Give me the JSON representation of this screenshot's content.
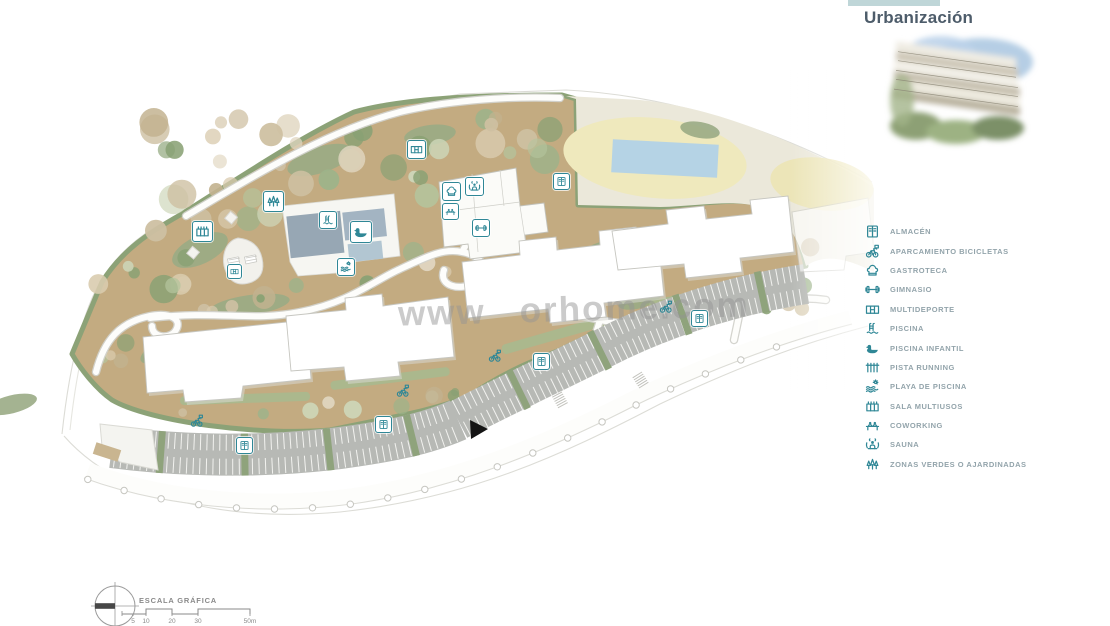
{
  "panel": {
    "title": "Urbanización",
    "art": "watercolor-building-rendering"
  },
  "legend": {
    "icon_color": "#2f8796",
    "label_color": "#93a4ab",
    "items": [
      {
        "icon": "almacen-icon",
        "label": "ALMACÉN"
      },
      {
        "icon": "bicycle-parking-icon",
        "label": "APARCAMIENTO BICICLETAS"
      },
      {
        "icon": "gastroteca-icon",
        "label": "GASTROTECA"
      },
      {
        "icon": "gimnasio-icon",
        "label": "GIMNASIO"
      },
      {
        "icon": "multideporte-icon",
        "label": "MULTIDEPORTE"
      },
      {
        "icon": "piscina-icon",
        "label": "PISCINA"
      },
      {
        "icon": "piscina-infantil-icon",
        "label": "PISCINA INFANTIL"
      },
      {
        "icon": "pista-running-icon",
        "label": "PISTA RUNNING"
      },
      {
        "icon": "playa-de-piscina-icon",
        "label": "PLAYA DE PISCINA"
      },
      {
        "icon": "sala-multiusos-icon",
        "label": "SALA MULTIUSOS"
      },
      {
        "icon": "coworking-icon",
        "label": "COWORKING"
      },
      {
        "icon": "sauna-icon",
        "label": "SAUNA"
      },
      {
        "icon": "zonas-verdes-icon",
        "label": "ZONAS VERDES O AJARDINADAS"
      }
    ]
  },
  "map": {
    "watermark": {
      "prefix": "www",
      "suffix": "orhome.com"
    },
    "badges": [
      {
        "type": "multideporte",
        "x": 415,
        "y": 148,
        "size": 17
      },
      {
        "type": "zonas-verdes",
        "x": 272,
        "y": 200,
        "size": 19
      },
      {
        "type": "sala-multiusos",
        "x": 201,
        "y": 230,
        "size": 19
      },
      {
        "type": "piscina",
        "x": 327,
        "y": 219,
        "size": 16
      },
      {
        "type": "piscina-infantil",
        "x": 360,
        "y": 231,
        "size": 20
      },
      {
        "type": "playa-de-piscina",
        "x": 345,
        "y": 266,
        "size": 16
      },
      {
        "type": "gastroteca",
        "x": 450,
        "y": 190,
        "size": 17
      },
      {
        "type": "sauna",
        "x": 473,
        "y": 185,
        "size": 17
      },
      {
        "type": "coworking",
        "x": 449,
        "y": 210,
        "size": 15
      },
      {
        "type": "gimnasio",
        "x": 480,
        "y": 227,
        "size": 16
      },
      {
        "type": "almacen",
        "x": 560,
        "y": 180,
        "size": 15
      },
      {
        "type": "multideporte",
        "x": 233,
        "y": 270,
        "size": 13
      },
      {
        "type": "aparcamiento-bicicletas",
        "x": 197,
        "y": 421,
        "size": 15,
        "frame": false
      },
      {
        "type": "almacen",
        "x": 243,
        "y": 444,
        "size": 15
      },
      {
        "type": "aparcamiento-bicicletas",
        "x": 403,
        "y": 391,
        "size": 15,
        "frame": false
      },
      {
        "type": "almacen",
        "x": 382,
        "y": 423,
        "size": 15
      },
      {
        "type": "aparcamiento-bicicletas",
        "x": 495,
        "y": 356,
        "size": 15,
        "frame": false
      },
      {
        "type": "almacen",
        "x": 540,
        "y": 360,
        "size": 15
      },
      {
        "type": "aparcamiento-bicicletas",
        "x": 666,
        "y": 307,
        "size": 15,
        "frame": false
      },
      {
        "type": "almacen",
        "x": 698,
        "y": 317,
        "size": 15
      }
    ],
    "entrance_marker": "black-arrow"
  },
  "scale": {
    "label": "ESCALA GRÁFICA",
    "ticks": [
      "5",
      "10",
      "20",
      "30",
      "50m"
    ]
  },
  "colors": {
    "teal": "#2f8796",
    "legend_label": "#93a4ab",
    "title": "#4d5c6a",
    "terrain_tan": "#c3ab81",
    "terrain_sage": "#93a57e",
    "field_cream": "#ebe8da",
    "field_yellow": "#efe9bd",
    "pool_blue": "#b5d3e5",
    "parking_gray": "#b7b9b5",
    "building_white": "#ffffff",
    "watermark_gray": "#949494"
  }
}
